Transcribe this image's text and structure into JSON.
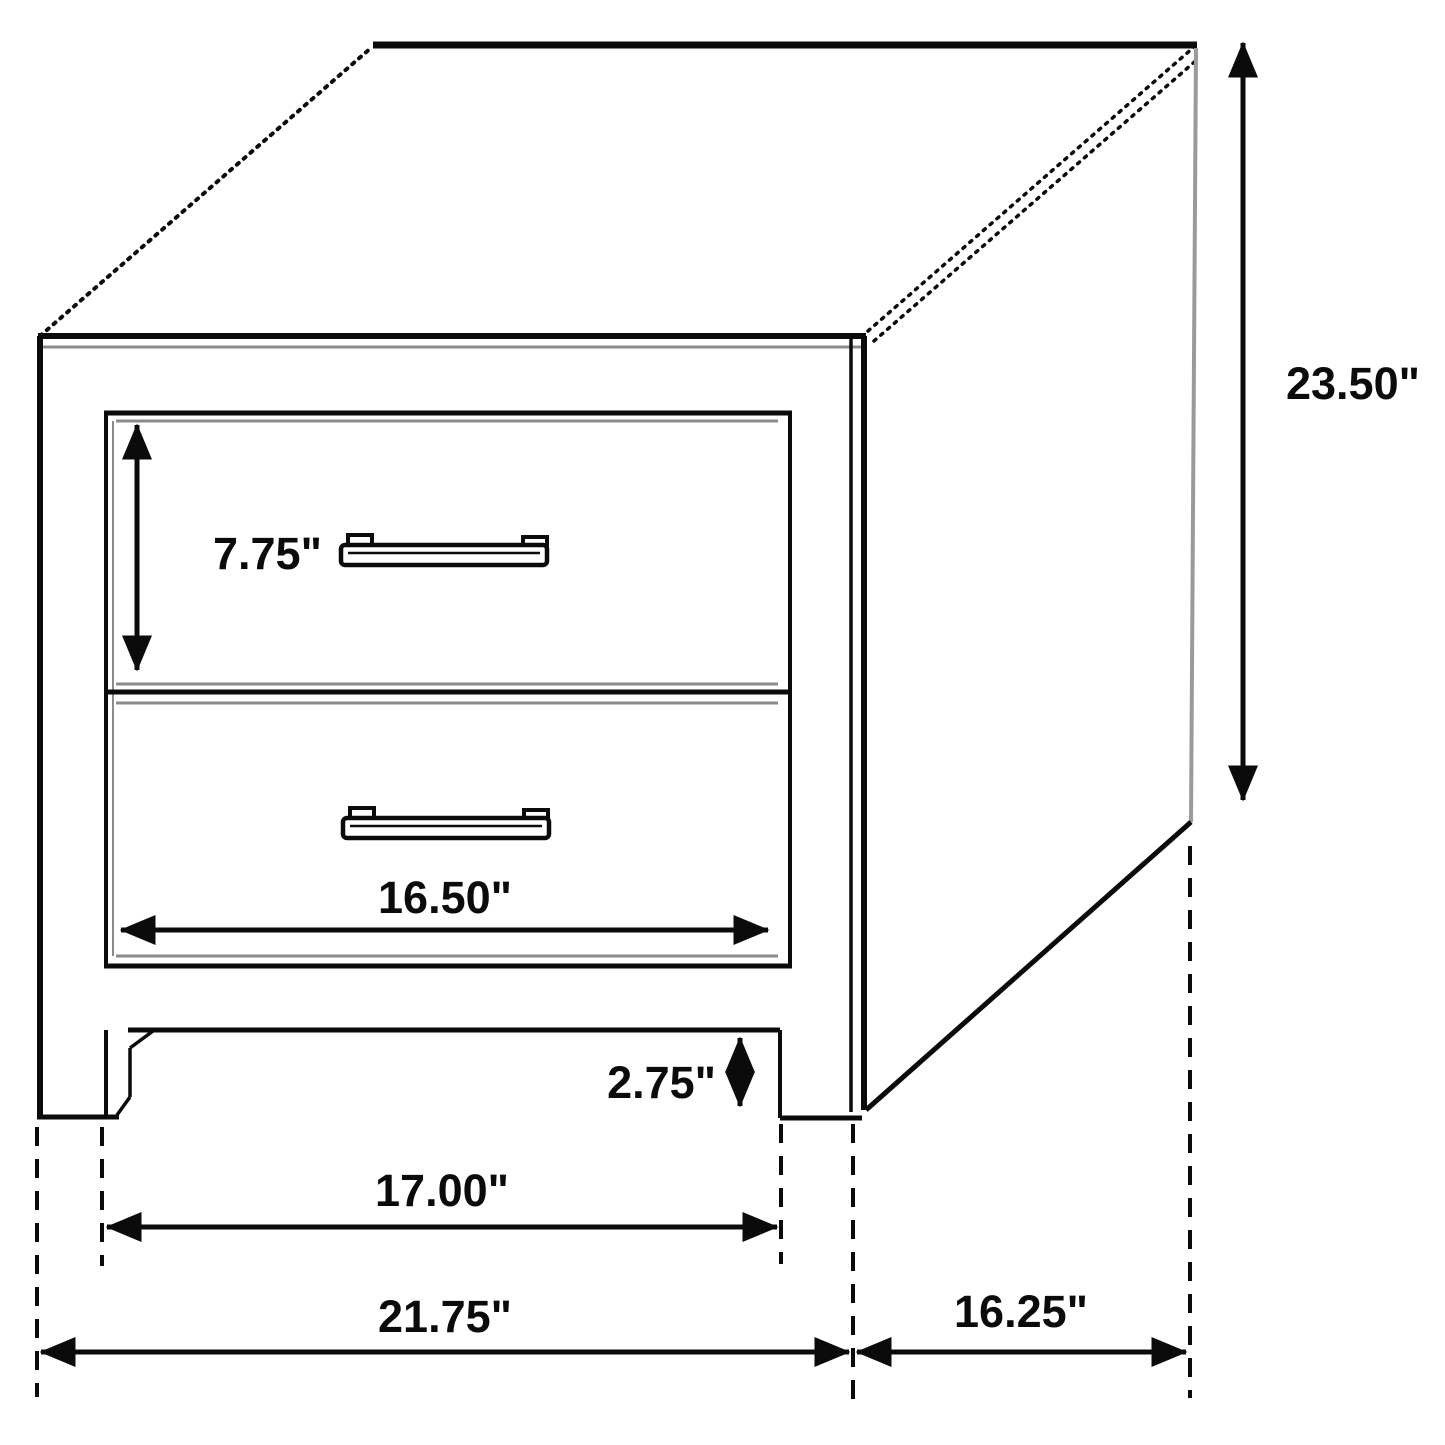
{
  "diagram": {
    "kind": "furniture-dimension-drawing",
    "subject": "two-drawer nightstand isometric line drawing",
    "unit": "inches",
    "colors": {
      "line": "#0b0b0b",
      "soft_line": "#8b8b8b",
      "background": "#ffffff"
    }
  },
  "labels": {
    "height": "23.50\"",
    "drawer_height": "7.75\"",
    "drawer_width": "16.50\"",
    "clearance": "2.75\"",
    "inner_width": "17.00\"",
    "overall_width": "21.75\"",
    "depth": "16.25\""
  }
}
